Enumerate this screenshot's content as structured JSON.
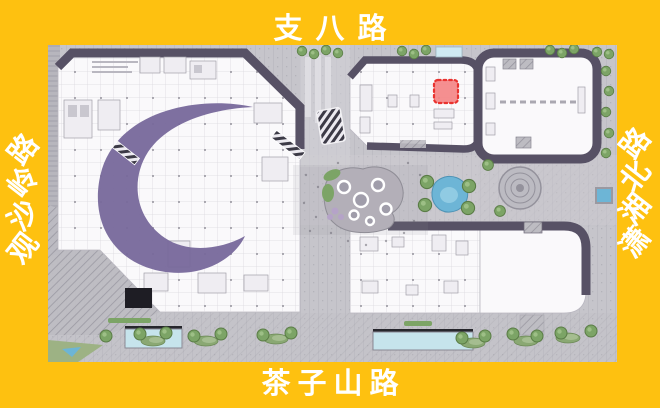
{
  "frame": {
    "background_color": "#FEC110",
    "label_color": "#FFFFFF"
  },
  "road_labels": {
    "top": "支八路",
    "bottom": "茶子山路",
    "left": "观沙岭路",
    "right": "潇湘北路"
  },
  "site_plan": {
    "highlighted_unit": {
      "fill": "#F58787",
      "border": "#E8231F"
    },
    "colors": {
      "frame-bg": "#FEC110",
      "label": "#FFFFFF",
      "pavement": "#C6C5CB",
      "building": "#FAF9FB",
      "roof": "#575165",
      "ribbon": "#77689B",
      "tree": "#7CA466",
      "water": "#6DB5D6",
      "pool": "#C6E4EC",
      "highlight-fill": "#F58787",
      "highlight-border": "#E8231F"
    }
  }
}
